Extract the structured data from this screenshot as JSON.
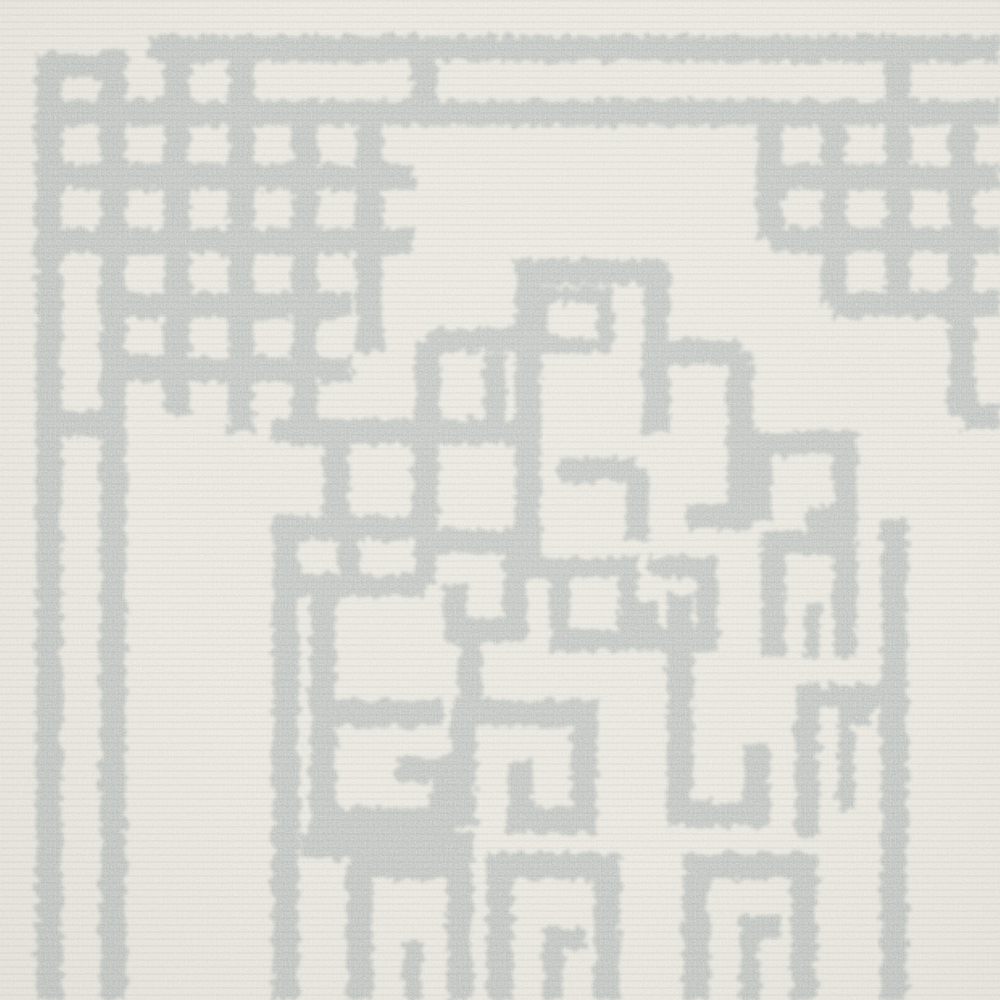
{
  "scene": {
    "description": "Close-up photograph of a hand-tufted wool rug: ivory cream ground with light gray Greek-key fretwork — thin double border lines along the top and left, an interlocking-squares knot ornament in the top-left corner, a partial knot at the top-right edge, and a dense Greek-key meander medallion filling the center and bottom."
  },
  "palette": {
    "background": "#ebe8de",
    "pattern_gray": "#b6bbb8",
    "speckle_dark_r": "0.63",
    "speckle_dark_g": "0.65",
    "speckle_dark_b": "0.62",
    "speckle_light": "#fbf9f1"
  },
  "pattern": {
    "stroke_width_default": 26,
    "strokes": [
      {
        "d": "M 150 49 H 1000"
      },
      {
        "d": "M 36 66 H 117",
        "w": 24
      },
      {
        "d": "M 49 66 V 1000"
      },
      {
        "d": "M 49 113 H 1000"
      },
      {
        "d": "M 113 49 V 1000"
      },
      {
        "d": "M 49 177 H 415"
      },
      {
        "d": "M 49 241 H 415"
      },
      {
        "d": "M 113 305 H 352"
      },
      {
        "d": "M 113 369 H 352"
      },
      {
        "d": "M 177 49 V 415"
      },
      {
        "d": "M 241 49 V 433"
      },
      {
        "d": "M 305 113 V 433"
      },
      {
        "d": "M 369 113 V 352"
      },
      {
        "d": "M 424 49 V 113"
      },
      {
        "d": "M 49 424 H 113"
      },
      {
        "d": "M 770 113 V 240"
      },
      {
        "d": "M 834 113 V 304"
      },
      {
        "d": "M 898 49 V 304"
      },
      {
        "d": "M 962 113 V 416"
      },
      {
        "d": "M 770 177 H 1000"
      },
      {
        "d": "M 770 240 H 1000"
      },
      {
        "d": "M 834 304 H 1000"
      },
      {
        "d": "M 962 416 H 1000"
      },
      {
        "d": "M 656 432 V 272 H 528 V 560"
      },
      {
        "d": "M 540 295 H 605 V 345 H 540 Z",
        "w": 16
      },
      {
        "d": "M 272 432 H 528"
      },
      {
        "d": "M 336 432 V 528"
      },
      {
        "d": "M 425 432 V 528"
      },
      {
        "d": "M 272 528 H 432"
      },
      {
        "d": "M 272 585 H 425",
        "w": 22
      },
      {
        "d": "M 349 528 V 585",
        "w": 22
      },
      {
        "d": "M 425 528 V 585",
        "w": 22
      },
      {
        "d": "M 286 528 V 1000"
      },
      {
        "d": "M 428 340 V 432"
      },
      {
        "d": "M 428 340 H 528",
        "w": 24
      },
      {
        "d": "M 495 353 V 432",
        "w": 22
      },
      {
        "d": "M 432 541 H 515 V 630 H 455 V 584",
        "w": 24
      },
      {
        "d": "M 560 567 H 628 V 640 H 560 Z",
        "w": 20
      },
      {
        "d": "M 648 567 H 707 V 640 H 648 V 602",
        "w": 22
      },
      {
        "d": "M 560 470 H 637",
        "w": 24
      },
      {
        "d": "M 637 470 V 540",
        "w": 24
      },
      {
        "d": "M 656 352 H 740"
      },
      {
        "d": "M 740 352 V 517 H 686"
      },
      {
        "d": "M 760 519 V 443 H 845 V 519 H 806",
        "w": 24
      },
      {
        "d": "M 773 657 V 543 H 845 V 657",
        "w": 24
      },
      {
        "d": "M 812 657 V 604",
        "w": 16
      },
      {
        "d": "M 894 519 V 1000"
      },
      {
        "d": "M 807 837 V 697 H 894",
        "w": 24
      },
      {
        "d": "M 846 810 V 717 H 872",
        "w": 16
      },
      {
        "d": "M 680 592 V 814 H 757 V 744"
      },
      {
        "d": "M 443 713 H 323 V 820 H 443 V 770 H 397"
      },
      {
        "d": "M 463 826 V 713 H 584 V 820 H 520 V 762"
      },
      {
        "d": "M 300 845 H 473"
      },
      {
        "d": "M 360 1000 V 866 H 460 V 1000"
      },
      {
        "d": "M 413 1000 V 942",
        "w": 20
      },
      {
        "d": "M 500 1000 V 866 H 607 V 1000"
      },
      {
        "d": "M 553 1000 V 938 H 585",
        "w": 20
      },
      {
        "d": "M 696 1000 V 866 H 804 V 1000"
      },
      {
        "d": "M 750 1000 V 926 H 781",
        "w": 20
      },
      {
        "d": "M 323 585 V 713"
      },
      {
        "d": "M 515 567 H 560",
        "w": 20
      },
      {
        "d": "M 470 630 V 713",
        "w": 24
      }
    ]
  }
}
